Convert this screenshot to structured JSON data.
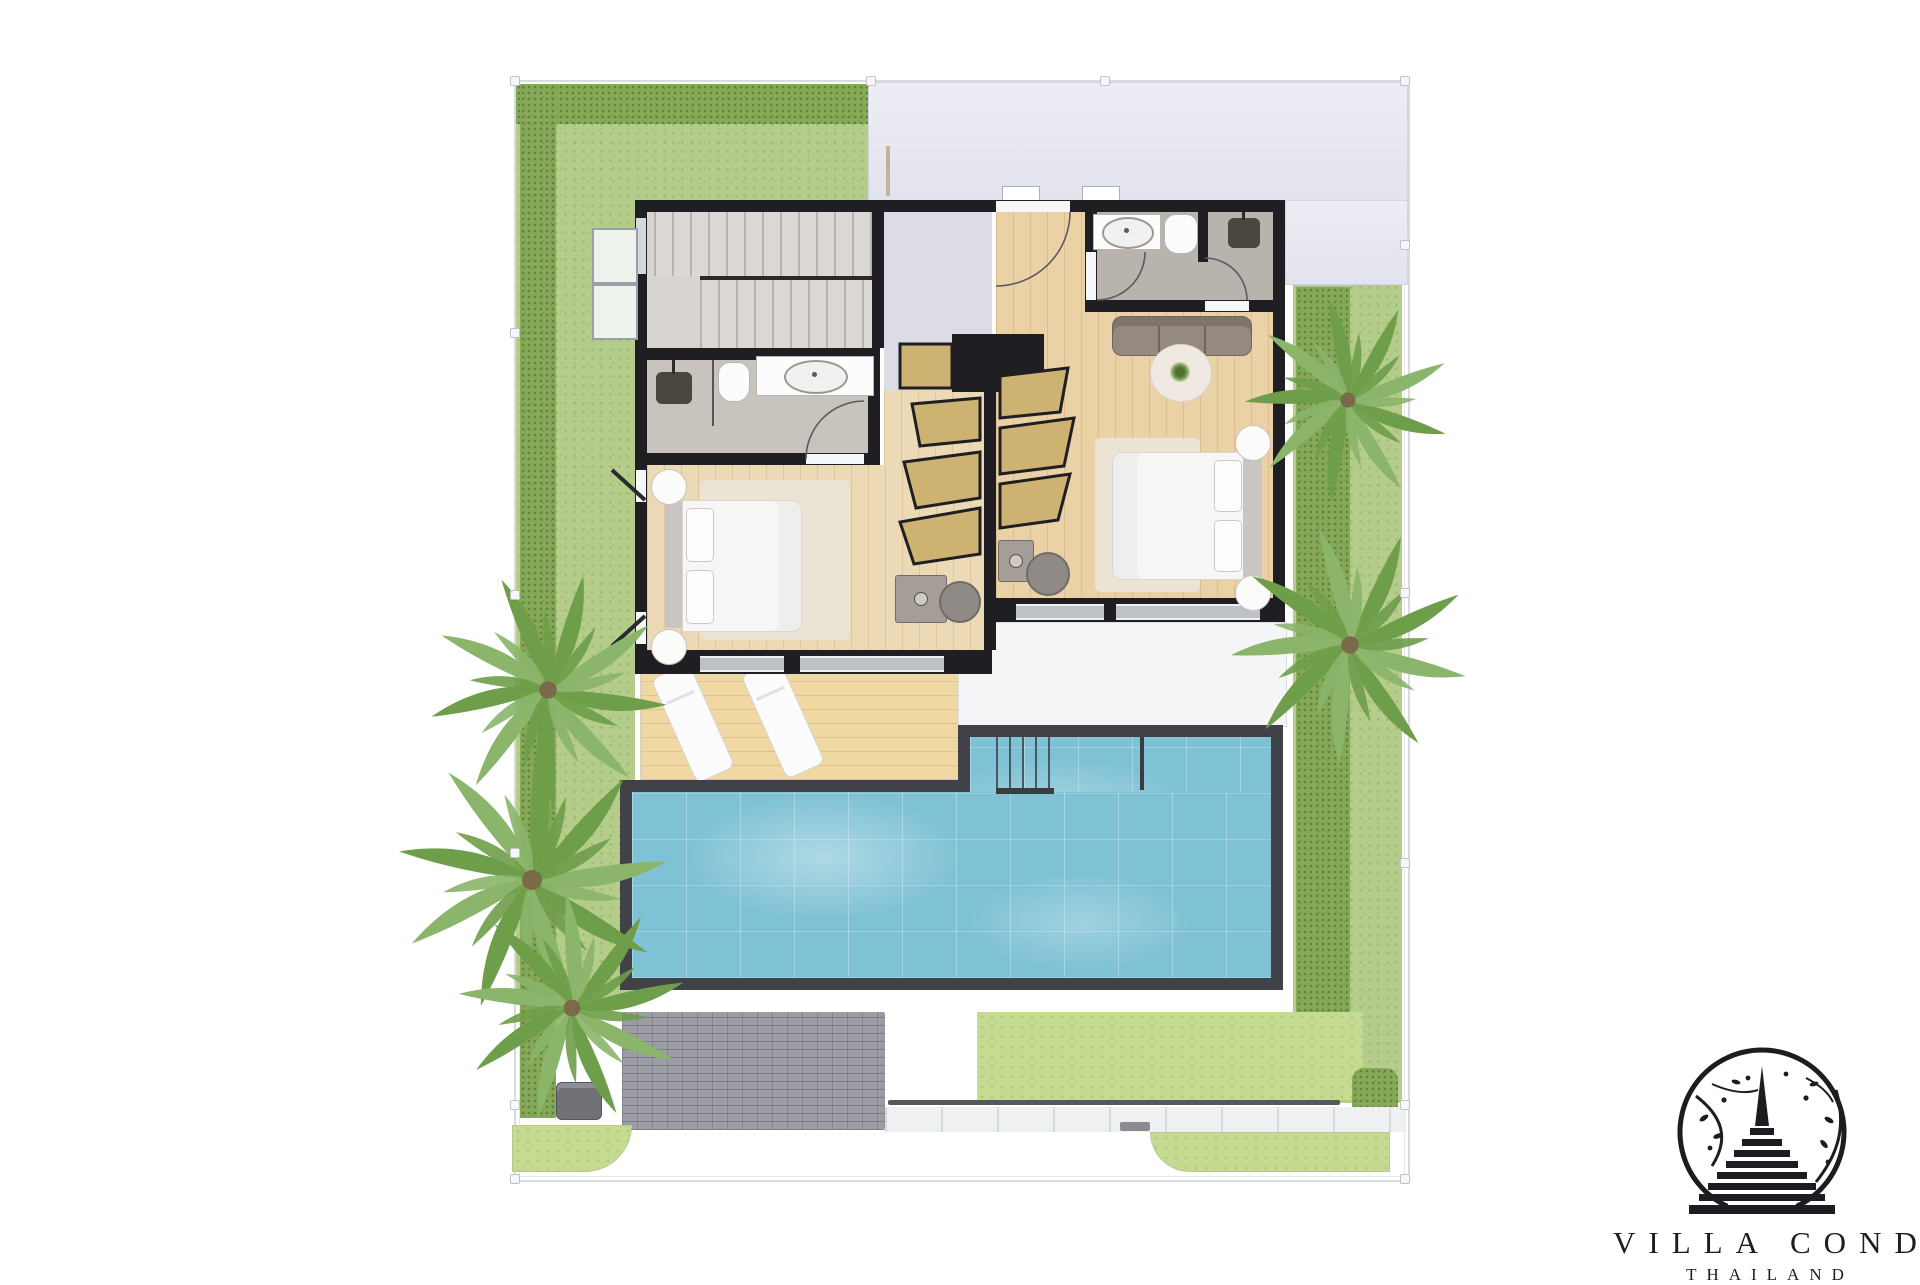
{
  "canvas": {
    "width": 1920,
    "height": 1280,
    "background": "#ffffff"
  },
  "branding": {
    "logo_icon": "stupa-in-circle-with-branches-emblem",
    "title": "VILLA CONDO",
    "subtitle": "THAILAND",
    "color": "#1d1d21"
  },
  "floor_plan": {
    "view": "top-down villa upper-floor plan with garden and pool",
    "zones": [
      "front-lawn",
      "left-lawn-strip",
      "right-lawn-strip",
      "roof-canopy",
      "stair-hall",
      "hallway",
      "bathroom-1",
      "bedroom-1",
      "walk-in-closet",
      "bathroom-2",
      "bedroom-2",
      "covered-terrace",
      "sun-deck",
      "swimming-pool",
      "paver-driveway",
      "walkway",
      "corner-grass-patches"
    ],
    "furniture": [
      "staircase",
      "double-bed-left",
      "double-bed-right",
      "three-seat-sofa",
      "round-rug-with-plant",
      "dressing-desk-left",
      "dressing-desk-right",
      "wardrobe-racks",
      "sun-loungers",
      "toilet-left",
      "toilet-right",
      "wash-basin-left",
      "wash-basin-right",
      "shower-left",
      "shower-right",
      "nightstands",
      "waste-bin"
    ],
    "vegetation": {
      "palm_trees": 5,
      "hedges": true,
      "lawn": true
    }
  },
  "palette": {
    "lawn": "#b5cd8a",
    "hedge": "#85a958",
    "grass_light": "#c6db92",
    "pool_water": "#7fc2d5",
    "pool_border": "#404247",
    "deck_wood": "#f0d8a2",
    "bedroom_wood": "#ecd9b6",
    "wall": "#1f1f23",
    "roof": "#e8e8f1",
    "paver": "#9c9ca4",
    "white_surface": "#f4f5f7"
  }
}
